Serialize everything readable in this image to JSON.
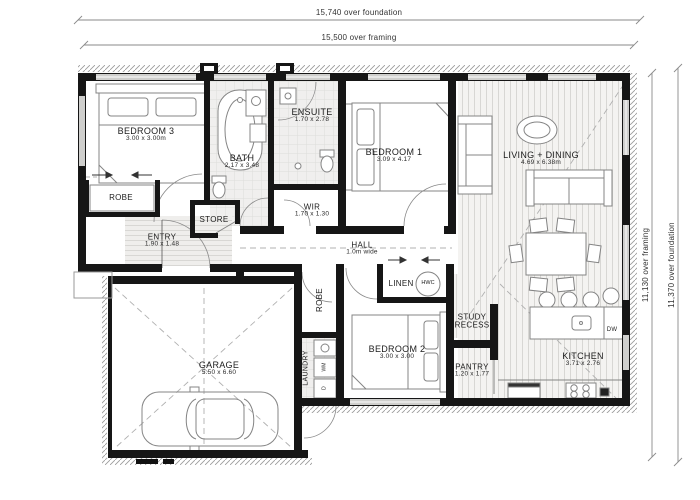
{
  "dims": {
    "top_foundation": "15,740 over foundation",
    "top_framing": "15,500 over framing",
    "right_framing": "11,130 over framing",
    "right_foundation": "11,370 over foundation"
  },
  "rooms": {
    "bedroom3": {
      "name": "BEDROOM 3",
      "size": "3.00 x 3.00m"
    },
    "robe3": {
      "name": "ROBE"
    },
    "bath": {
      "name": "BATH",
      "size": "2.17 x 3.48"
    },
    "store": {
      "name": "STORE"
    },
    "ensuite": {
      "name": "ENSUITE",
      "size": "1.70 x 2.78"
    },
    "bedroom1": {
      "name": "BEDROOM 1",
      "size": "3.09 x 4.17"
    },
    "wir": {
      "name": "WIR",
      "size": "1.70 x 1.30"
    },
    "entry": {
      "name": "ENTRY",
      "size": "1.90 x 1.48"
    },
    "hall": {
      "name": "HALL",
      "size": "1.0m wide"
    },
    "living": {
      "name": "LIVING + DINING",
      "size": "4.69 x 6.38m"
    },
    "linen": {
      "name": "LINEN"
    },
    "study": {
      "name": "STUDY",
      "name2": "RECESS"
    },
    "bedroom2": {
      "name": "BEDROOM 2",
      "size": "3.00 x 3.00"
    },
    "robe2": {
      "name": "ROBE"
    },
    "pantry": {
      "name": "PANTRY",
      "size": "1.20 x 1.77"
    },
    "kitchen": {
      "name": "KITCHEN",
      "size": "3.71 x 2.76"
    },
    "laundry": {
      "name": "LAUNDRY"
    },
    "garage": {
      "name": "GARAGE",
      "size": "5.50 x 6.60"
    }
  },
  "appliances": {
    "hwc": "HWC",
    "dw": "DW",
    "wm": "WM",
    "dryer": "D"
  },
  "colors": {
    "wall": "#161616",
    "furniture_line": "#808080",
    "tile": "#f0efee",
    "timber": "#f4f3f1"
  }
}
